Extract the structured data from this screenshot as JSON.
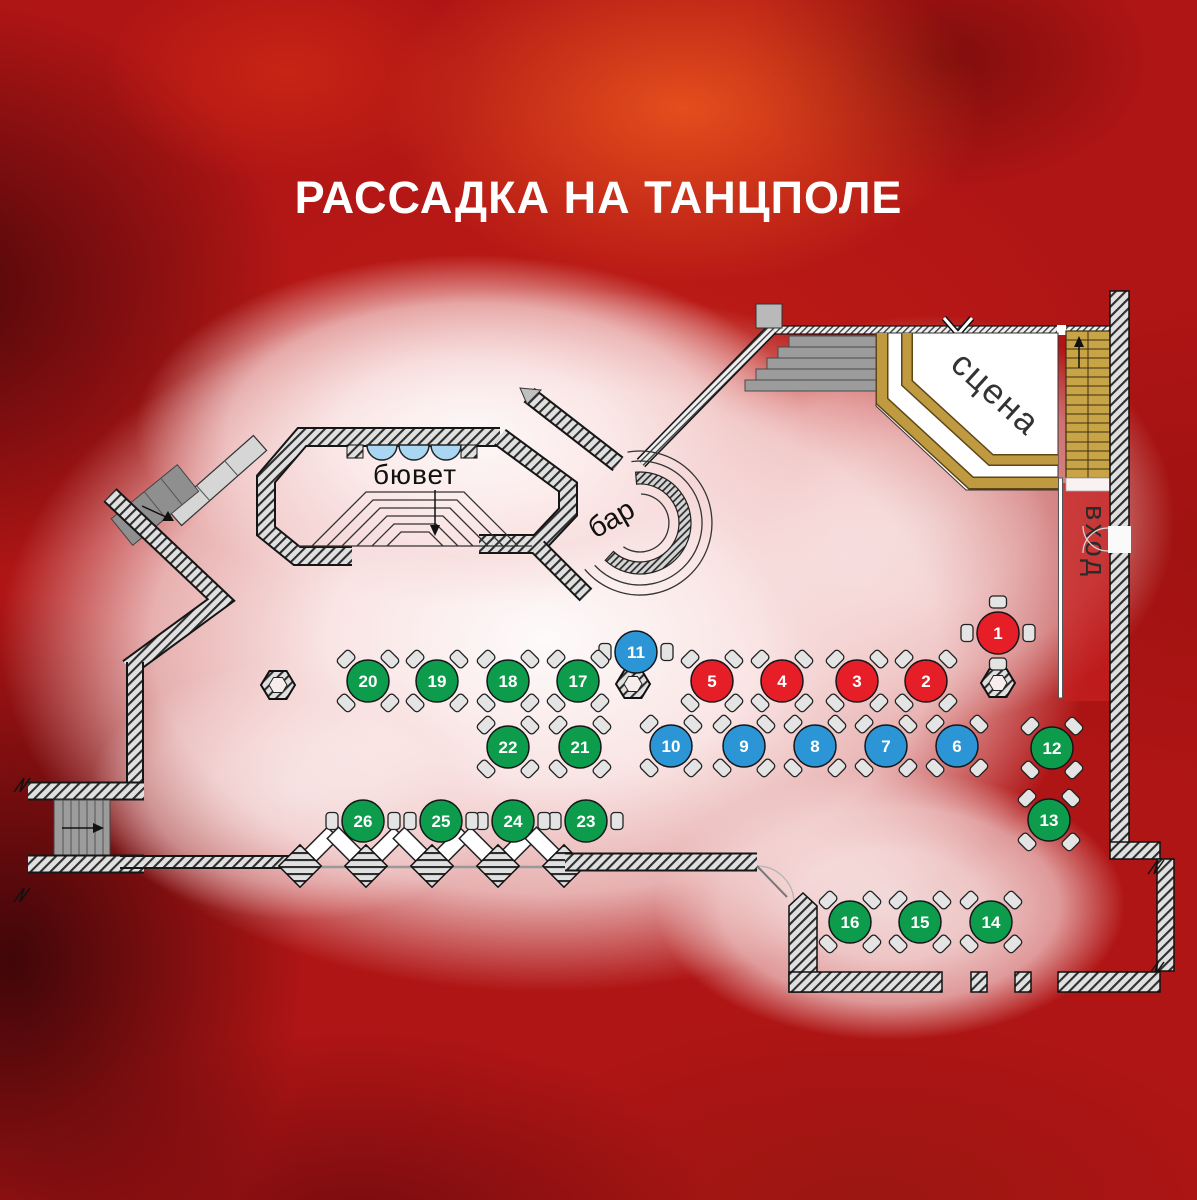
{
  "title": "РАССАДКА НА ТАНЦПОЛЕ",
  "labels": {
    "buffet": "бювет",
    "bar": "бар",
    "stage": "сцена",
    "entrance": "вход"
  },
  "table_colors": {
    "red": "#e61e28",
    "blue": "#2b95d6",
    "green": "#0c9c4b"
  },
  "tables": [
    {
      "n": "1",
      "color": "red",
      "x": 998,
      "y": 633,
      "chairs": "cross"
    },
    {
      "n": "2",
      "color": "red",
      "x": 926,
      "y": 681,
      "chairs": "diag"
    },
    {
      "n": "3",
      "color": "red",
      "x": 857,
      "y": 681,
      "chairs": "diag"
    },
    {
      "n": "4",
      "color": "red",
      "x": 782,
      "y": 681,
      "chairs": "diag"
    },
    {
      "n": "5",
      "color": "red",
      "x": 712,
      "y": 681,
      "chairs": "diag"
    },
    {
      "n": "6",
      "color": "blue",
      "x": 957,
      "y": 746,
      "chairs": "diag"
    },
    {
      "n": "7",
      "color": "blue",
      "x": 886,
      "y": 746,
      "chairs": "diag"
    },
    {
      "n": "8",
      "color": "blue",
      "x": 815,
      "y": 746,
      "chairs": "diag"
    },
    {
      "n": "9",
      "color": "blue",
      "x": 744,
      "y": 746,
      "chairs": "diag"
    },
    {
      "n": "10",
      "color": "blue",
      "x": 671,
      "y": 746,
      "chairs": "diag"
    },
    {
      "n": "11",
      "color": "blue",
      "x": 636,
      "y": 652,
      "chairs": "sides"
    },
    {
      "n": "12",
      "color": "green",
      "x": 1052,
      "y": 748,
      "chairs": "diag"
    },
    {
      "n": "13",
      "color": "green",
      "x": 1049,
      "y": 820,
      "chairs": "diag"
    },
    {
      "n": "14",
      "color": "green",
      "x": 991,
      "y": 922,
      "chairs": "diag"
    },
    {
      "n": "15",
      "color": "green",
      "x": 920,
      "y": 922,
      "chairs": "diag"
    },
    {
      "n": "16",
      "color": "green",
      "x": 850,
      "y": 922,
      "chairs": "diag"
    },
    {
      "n": "17",
      "color": "green",
      "x": 578,
      "y": 681,
      "chairs": "diag"
    },
    {
      "n": "18",
      "color": "green",
      "x": 508,
      "y": 681,
      "chairs": "diag"
    },
    {
      "n": "19",
      "color": "green",
      "x": 437,
      "y": 681,
      "chairs": "diag"
    },
    {
      "n": "20",
      "color": "green",
      "x": 368,
      "y": 681,
      "chairs": "diag"
    },
    {
      "n": "21",
      "color": "green",
      "x": 580,
      "y": 747,
      "chairs": "diag"
    },
    {
      "n": "22",
      "color": "green",
      "x": 508,
      "y": 747,
      "chairs": "diag"
    },
    {
      "n": "23",
      "color": "green",
      "x": 586,
      "y": 821,
      "chairs": "sides"
    },
    {
      "n": "24",
      "color": "green",
      "x": 513,
      "y": 821,
      "chairs": "sides"
    },
    {
      "n": "25",
      "color": "green",
      "x": 441,
      "y": 821,
      "chairs": "sides"
    },
    {
      "n": "26",
      "color": "green",
      "x": 363,
      "y": 821,
      "chairs": "sides"
    }
  ],
  "pillars": [
    {
      "x": 278,
      "y": 685
    },
    {
      "x": 633,
      "y": 684
    },
    {
      "x": 998,
      "y": 683
    }
  ]
}
